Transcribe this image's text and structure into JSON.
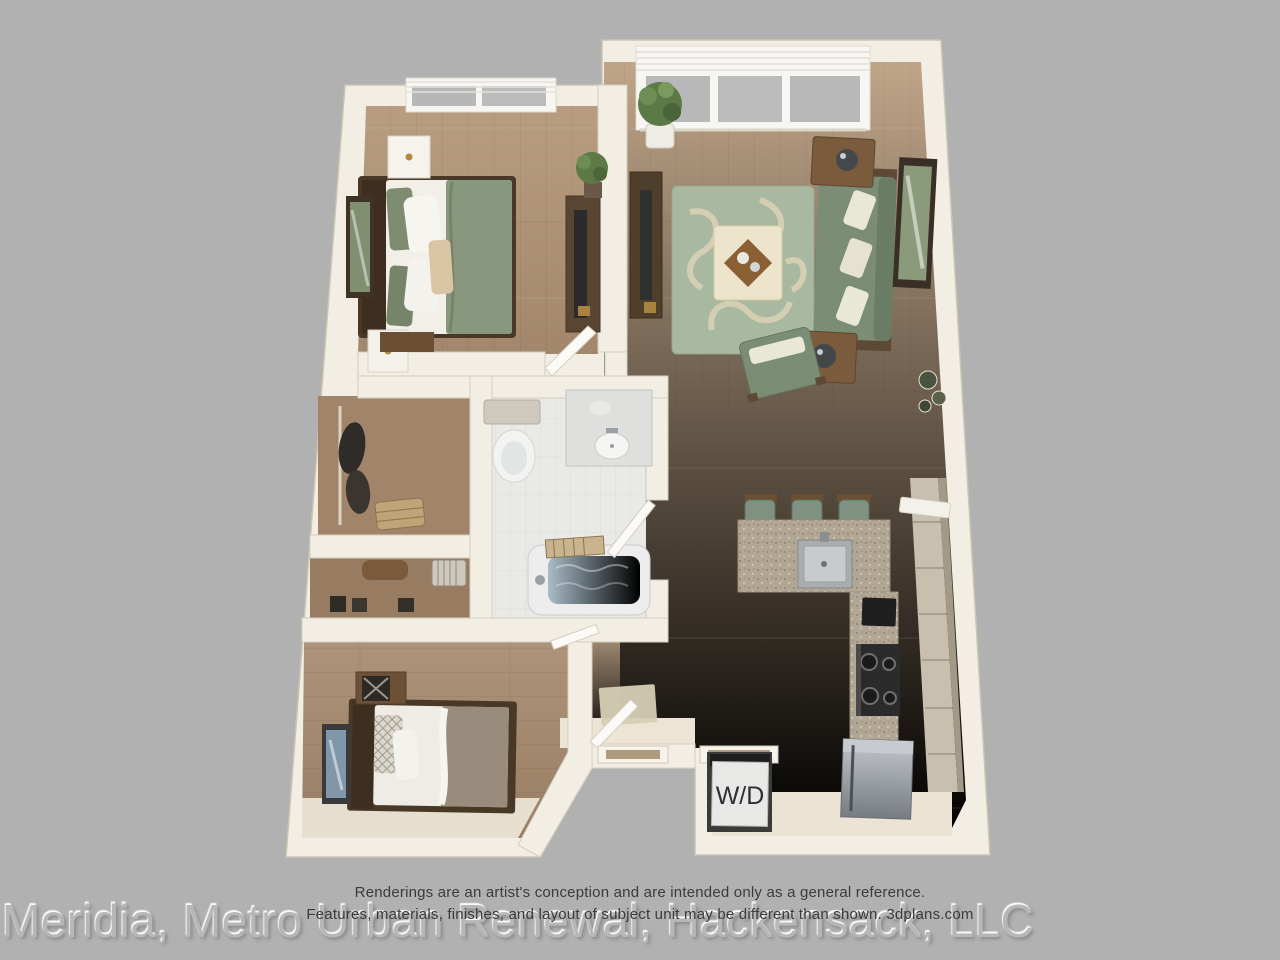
{
  "scene": {
    "description": "3D aerial rendering of a one-bedroom-plus-den apartment floor plan",
    "laundry_label": "W/D"
  },
  "disclaimer": {
    "line1": "Renderings are an artist's conception and are intended only as a general reference.",
    "line2": "Features, materials, finishes, and layout of subject unit may be different than shown. 3dplans.com"
  },
  "watermark": {
    "text": "Meridia, Metro Urban Renewal, Hackensack, LLC"
  },
  "palette": {
    "background": "#b1b1b1",
    "wall": "#f3eee4",
    "wall_shade": "#d9d2c2",
    "wood_floor": "#b3987b",
    "bathroom_tile": "#e9e9e7",
    "sofa_green": "#7b8d74",
    "rug_green": "#a9b9a1",
    "rug_pattern_cream": "#ddd5bb",
    "ottoman_cream": "#ece4ca",
    "granite_counter": "#b1a794",
    "stainless_steel": "#9aa0a4",
    "dark_wood": "#55412f",
    "tub_water": "#90a7b7",
    "text_dark": "#3b3b3b",
    "watermark_gray": "#b7b7b7"
  }
}
